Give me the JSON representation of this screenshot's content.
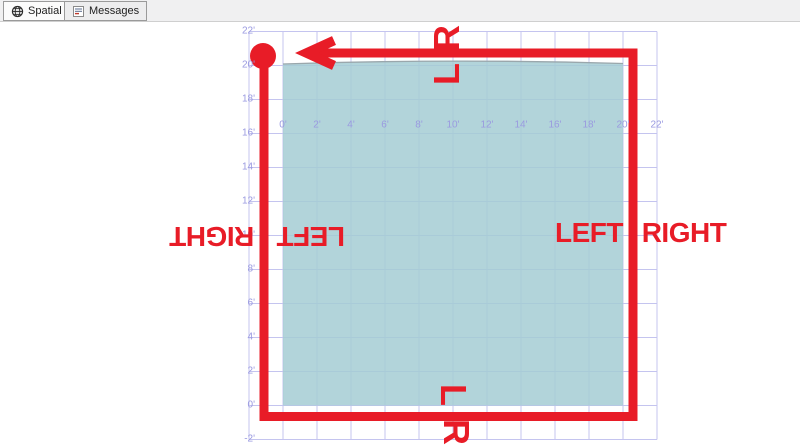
{
  "tabs": [
    {
      "label": "Spatial results",
      "icon": "globe-icon",
      "active": true
    },
    {
      "label": "Messages",
      "icon": "messages-icon",
      "active": false
    }
  ],
  "chart_data": {
    "type": "spatial-map",
    "x_tick_labels": [
      "0'",
      "2'",
      "4'",
      "6'",
      "8'",
      "10'",
      "12'",
      "14'",
      "16'",
      "18'",
      "20'",
      "22'"
    ],
    "x_tick_values": [
      0,
      2,
      4,
      6,
      8,
      10,
      12,
      14,
      16,
      18,
      20,
      22
    ],
    "y_tick_labels": [
      "22'",
      "20'",
      "18'",
      "16'",
      "14'",
      "12'",
      "10'",
      "8'",
      "6'",
      "4'",
      "2'",
      "0'",
      "-2'"
    ],
    "y_tick_values": [
      22,
      20,
      18,
      16,
      14,
      12,
      10,
      8,
      6,
      4,
      2,
      0,
      -2
    ],
    "grid_values": [
      -2,
      0,
      2,
      4,
      6,
      8,
      10,
      12,
      14,
      16,
      18,
      20,
      22
    ],
    "axis_range": {
      "x": [
        -2,
        22
      ],
      "y": [
        -2,
        22
      ]
    },
    "grid_on": true,
    "polygon": {
      "vertices": [
        [
          0,
          0
        ],
        [
          20,
          0
        ],
        [
          20,
          20
        ],
        [
          0,
          20
        ]
      ]
    },
    "ring_annotation": {
      "direction": "counterclockwise",
      "start_corner": "top-left",
      "arrow_points": "west"
    }
  },
  "annotations": {
    "top": {
      "outside": "R",
      "inside": "L"
    },
    "bottom": {
      "inside": "L",
      "outside": "R"
    },
    "left": {
      "outside": "RIGHT",
      "inside": "LEFT"
    },
    "right": {
      "inside": "LEFT",
      "outside": "RIGHT"
    }
  },
  "colors": {
    "annotation_red": "#e81c27",
    "polygon_fill": "#a5cdd3",
    "polygon_border": "#9aa7ac",
    "gridline": "#c4c4ef",
    "axis_label": "#9a9ae0"
  }
}
